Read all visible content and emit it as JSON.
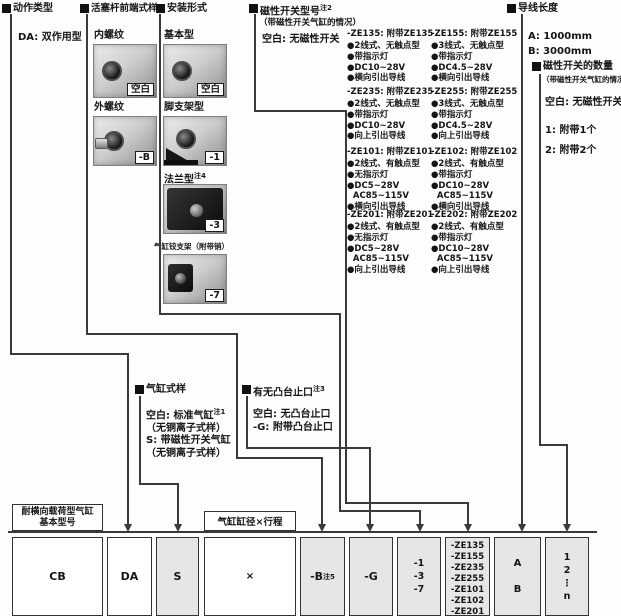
{
  "action_type": {
    "title": "动作类型",
    "item": "DA: 双作用型"
  },
  "rod_end": {
    "title": "活塞杆前端式样",
    "opt1_name": "内螺纹",
    "opt1_code": "空白",
    "opt2_name": "外螺纹",
    "opt2_code": "-B"
  },
  "mounting": {
    "title": "安装形式",
    "opt1_name": "基本型",
    "opt1_code": "空白",
    "opt2_name": "脚支架型",
    "opt2_code": "-1",
    "opt3_name": "法兰型",
    "opt3_sup": "注4",
    "opt3_code": "-3",
    "opt4_name": "气缸铰支架（附带销）",
    "opt4_code": "-7"
  },
  "switch_model": {
    "title": "磁性开关型号",
    "title_sup": "注2",
    "subtitle": "（带磁性开关气缸的情况）",
    "blank": "空白: 无磁性开关",
    "columns": [
      {
        "code": "-ZE135:",
        "name": "附带ZE135",
        "bullets": "●2线式、无触点型\n●带指示灯\n●DC10~28V\n●横向引出导线"
      },
      {
        "code": "-ZE155:",
        "name": "附带ZE155",
        "bullets": "●3线式、无触点型\n●带指示灯\n●DC4.5~28V\n●横向引出导线"
      },
      {
        "code": "-ZE235:",
        "name": "附带ZE235",
        "bullets": "●2线式、无触点型\n●带指示灯\n●DC10~28V\n●向上引出导线"
      },
      {
        "code": "-ZE255:",
        "name": "附带ZE255",
        "bullets": "●3线式、无触点型\n●带指示灯\n●DC4.5~28V\n●向上引出导线"
      },
      {
        "code": "-ZE101:",
        "name": "附带ZE101",
        "bullets": "●2线式、有触点型\n●无指示灯\n●DC5~28V\n  AC85~115V\n●横向引出导线"
      },
      {
        "code": "-ZE102:",
        "name": "附带ZE102",
        "bullets": "●2线式、有触点型\n●带指示灯\n●DC10~28V\n  AC85~115V\n●横向引出导线"
      },
      {
        "code": "-ZE201:",
        "name": "附带ZE201",
        "bullets": "●2线式、有触点型\n●无指示灯\n●DC5~28V\n  AC85~115V\n●向上引出导线"
      },
      {
        "code": "-ZE202:",
        "name": "附带ZE202",
        "bullets": "●2线式、有触点型\n●带指示灯\n●DC10~28V\n  AC85~115V\n●向上引出导线"
      }
    ]
  },
  "lead_wire": {
    "title": "导线长度",
    "items": "A: 1000mm\nB: 3000mm"
  },
  "switch_qty": {
    "title": "磁性开关的数量",
    "subtitle": "（带磁性开关气缸的情况）",
    "blank": "空白: 无磁性开关",
    "item1": "1: 附带1个",
    "item2": "2: 附带2个"
  },
  "cylinder_style": {
    "title": "气缸式样",
    "blank_label": "空白: 标准气缸",
    "blank_sup": "注1",
    "blank_paren": "（无铜离子式样）",
    "s_label": "S: 带磁性开关气缸",
    "s_paren": "（无铜离子式样）"
  },
  "boss": {
    "title": "有无凸台止口",
    "title_sup": "注3",
    "line1": "空白: 无凸台止口",
    "line2": "-G: 附带凸台止口"
  },
  "table": {
    "label_basic_line1": "耐横向载荷型气缸",
    "label_basic_line2": "基本型号",
    "label_bore": "气缸缸径×行程",
    "cell_cb": "CB",
    "cell_da": "DA",
    "cell_s": "S",
    "cell_x": "×",
    "cell_b": "-B",
    "cell_b_sup": "注5",
    "cell_g": "-G",
    "cell_mount": "-1\n-3\n-7",
    "cell_switch": "-ZE135\n-ZE155\n-ZE235\n-ZE255\n-ZE101\n-ZE102\n-ZE201\n-ZE202",
    "cell_lead": "A\n\nB",
    "cell_qty": "1\n2\n⋮\nn"
  },
  "colors": {
    "line": "#3a3a3a",
    "cell_gray": "#e6e6e6",
    "text": "#151515"
  }
}
